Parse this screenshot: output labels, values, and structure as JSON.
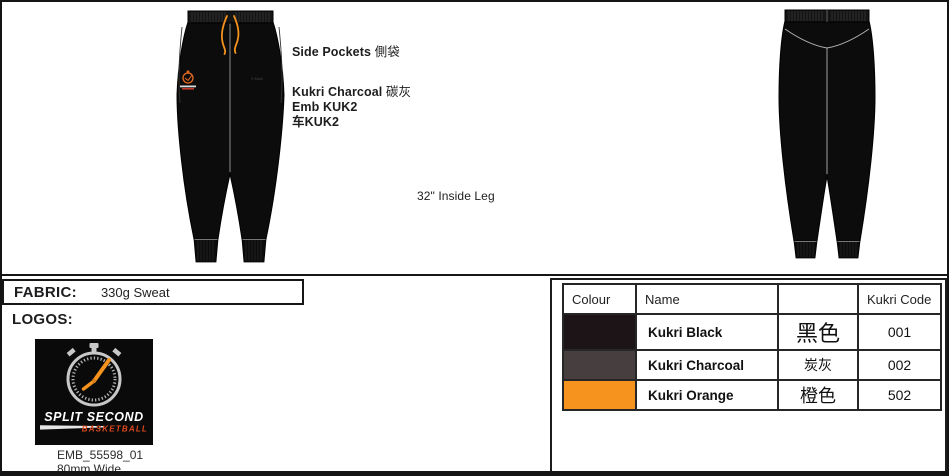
{
  "annotations": {
    "side_pockets_en": "Side Pockets",
    "side_pockets_zh": "側袋",
    "trim_colour_en": "Kukri Charcoal",
    "trim_colour_zh": "碳灰",
    "emb_code": "Emb KUK2",
    "stitch_code": "车KUK2",
    "inside_leg": "32\" Inside Leg",
    "watermark": "© Kukri"
  },
  "fabric": {
    "label": "FABRIC:",
    "value": "330g Sweat"
  },
  "logos": {
    "label": "LOGOS:",
    "brand_line1": "SPLIT SECOND",
    "brand_line2": "BASKETBALL",
    "ref": "EMB_55598_01",
    "width_note": "80mm Wide"
  },
  "colour_table": {
    "headers": [
      "Colour",
      "Name",
      "",
      "Kukri Code"
    ],
    "rows": [
      {
        "swatch": "#1c1417",
        "name": "Kukri Black",
        "zh": "黑色",
        "code": "001"
      },
      {
        "swatch": "#473f3f",
        "name": "Kukri Charcoal",
        "zh": "炭灰",
        "code": "002"
      },
      {
        "swatch": "#f6921e",
        "name": "Kukri Orange",
        "zh": "橙色",
        "code": "502"
      }
    ]
  },
  "colors": {
    "garment": "#0c0c0c",
    "drawstring": "#f6921e",
    "seam": "#9a9a9a",
    "logo_accent": "#e04a1c"
  }
}
